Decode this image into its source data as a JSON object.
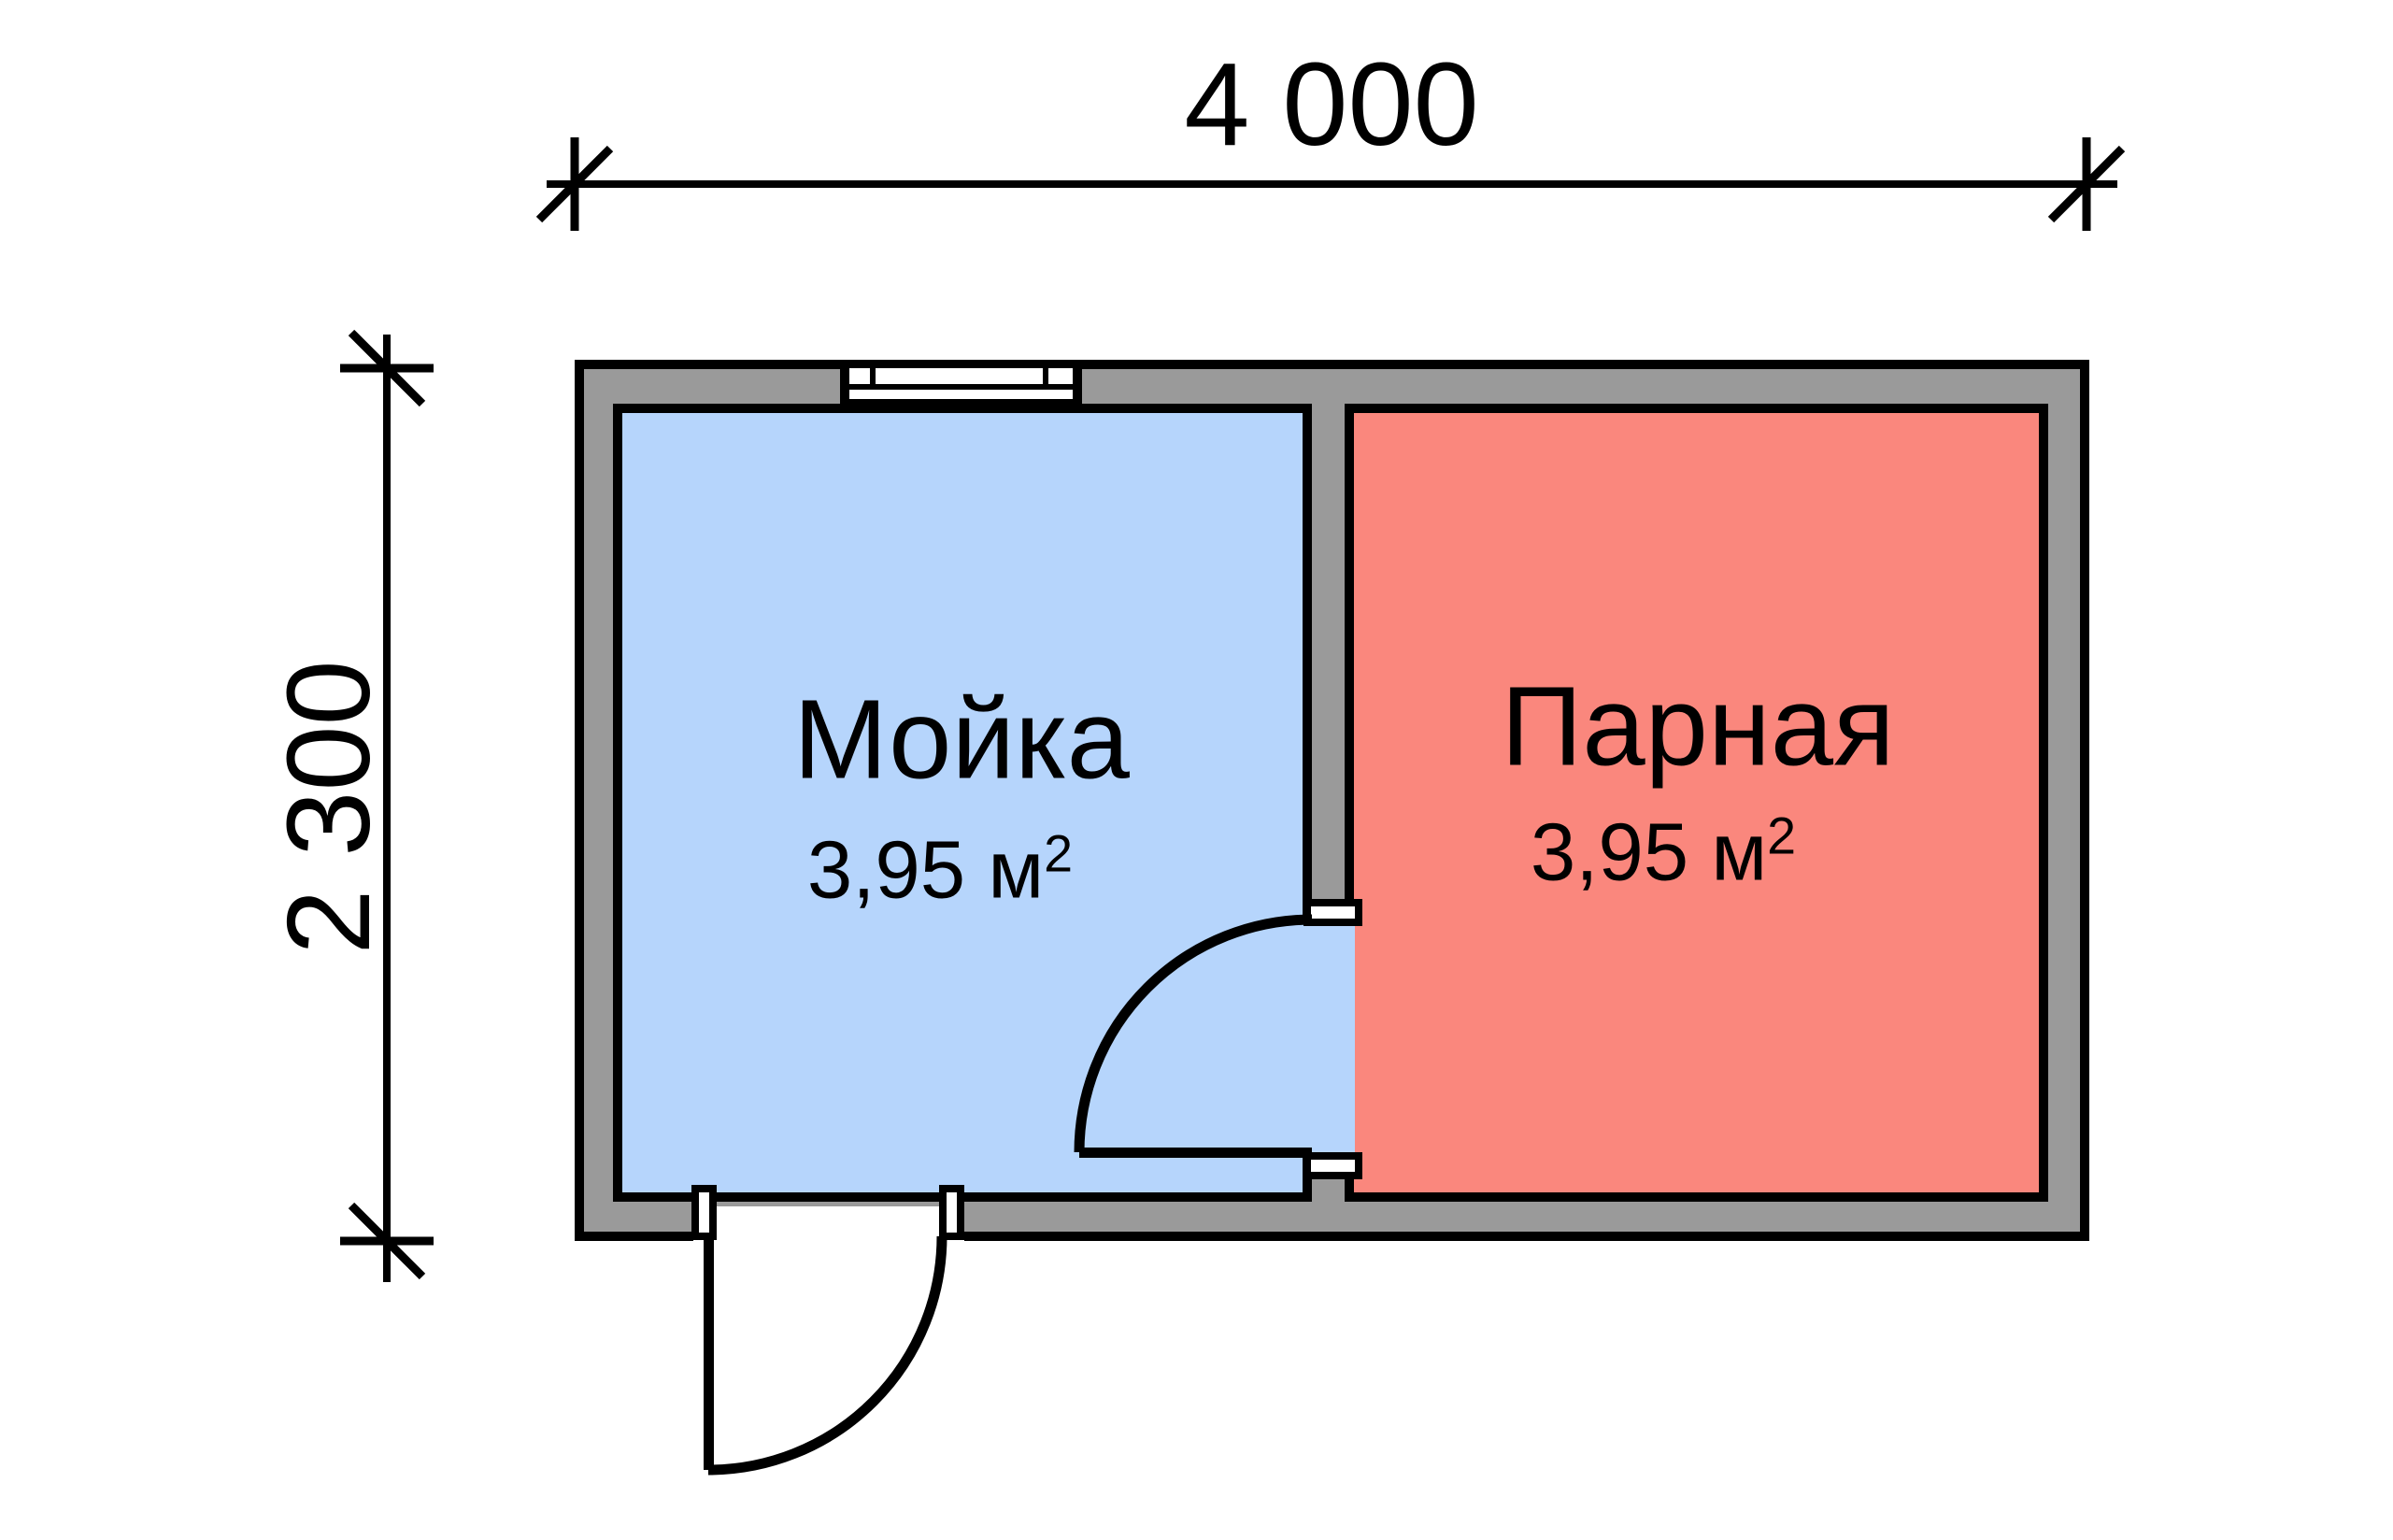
{
  "plan": {
    "dimensions": {
      "width_label": "4 000",
      "height_label": "2 300"
    },
    "rooms": [
      {
        "name": "Мойка",
        "area_value": "3,95 м",
        "area_sup": "2",
        "fill": "#b6d5fc"
      },
      {
        "name": "Парная",
        "area_value": "3,95 м",
        "area_sup": "2",
        "fill": "#fa877d"
      }
    ],
    "colors": {
      "wall_fill": "#9a9a9a",
      "line": "#000000",
      "opening_fill": "#ffffff",
      "background": "#ffffff"
    }
  }
}
